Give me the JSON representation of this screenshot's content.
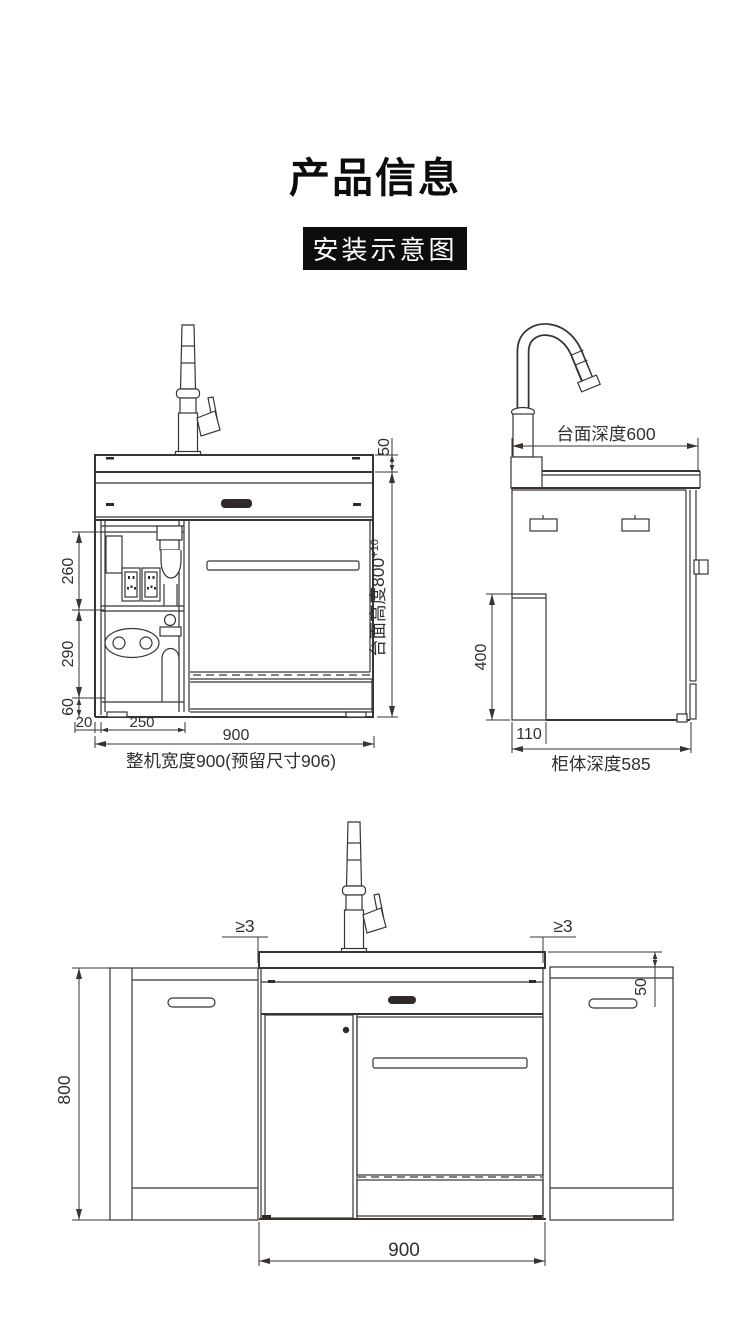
{
  "page": {
    "title": "产品信息",
    "badge": "安装示意图"
  },
  "front_view": {
    "dim_counter_thickness": "50",
    "dim_counter_height": "台面高度800",
    "dim_counter_height_tol": "+10",
    "dim_socket_section": "260",
    "dim_pipe_section": "290",
    "dim_plinth": "60",
    "dim_side_inset": "20",
    "dim_compartment_width": "250",
    "dim_width": "900",
    "label_overall_width": "整机宽度900(预留尺寸906)"
  },
  "side_view": {
    "label_counter_depth": "台面深度600",
    "dim_back_box_height": "400",
    "dim_back_box_depth": "110",
    "label_cabinet_depth": "柜体深度585"
  },
  "install_view": {
    "dim_gap_left": "≥3",
    "dim_gap_right": "≥3",
    "dim_counter_overhang": "50",
    "dim_height": "800",
    "dim_width": "900"
  }
}
